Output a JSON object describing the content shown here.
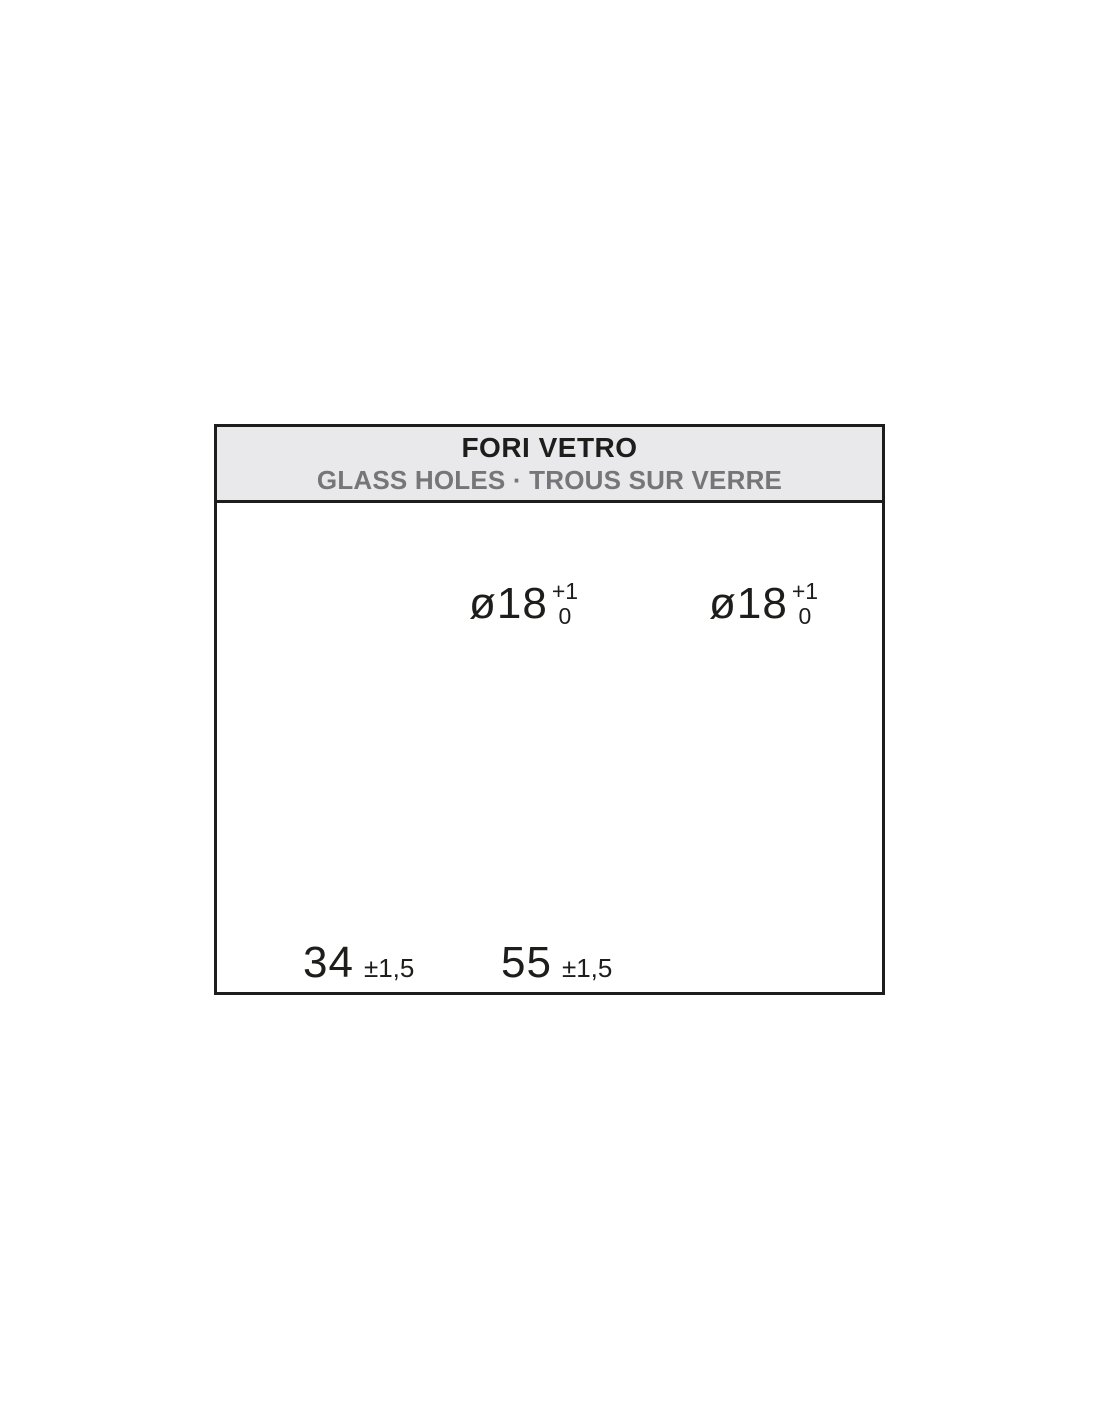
{
  "header": {
    "title": "FORI VETRO",
    "subtitle": "GLASS HOLES · TROUS SUR VERRE"
  },
  "diagram": {
    "holes": [
      {
        "diameter": "ø18",
        "tol_upper": "+1",
        "tol_lower": "0"
      },
      {
        "diameter": "ø18",
        "tol_upper": "+1",
        "tol_lower": "0"
      }
    ],
    "dimensions": [
      {
        "value": "34",
        "tolerance": "±1,5"
      },
      {
        "value": "55",
        "tolerance": "±1,5"
      }
    ],
    "colors": {
      "glass_fill": "#dceef9",
      "line": "#1d1d1b",
      "extension_line": "#808080",
      "header_bg": "#e9e9eb",
      "subtitle_text": "#76767a"
    }
  }
}
